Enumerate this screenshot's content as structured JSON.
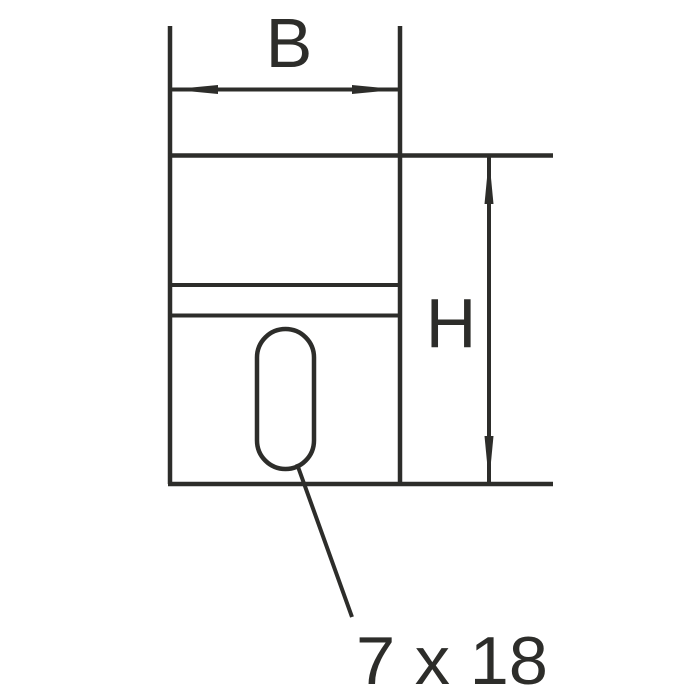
{
  "drawing": {
    "labels": {
      "width_dim": "B",
      "height_dim": "H",
      "slot_size": "7 x 18"
    },
    "colors": {
      "line": "#2d2d2a",
      "background": "#ffffff"
    }
  }
}
